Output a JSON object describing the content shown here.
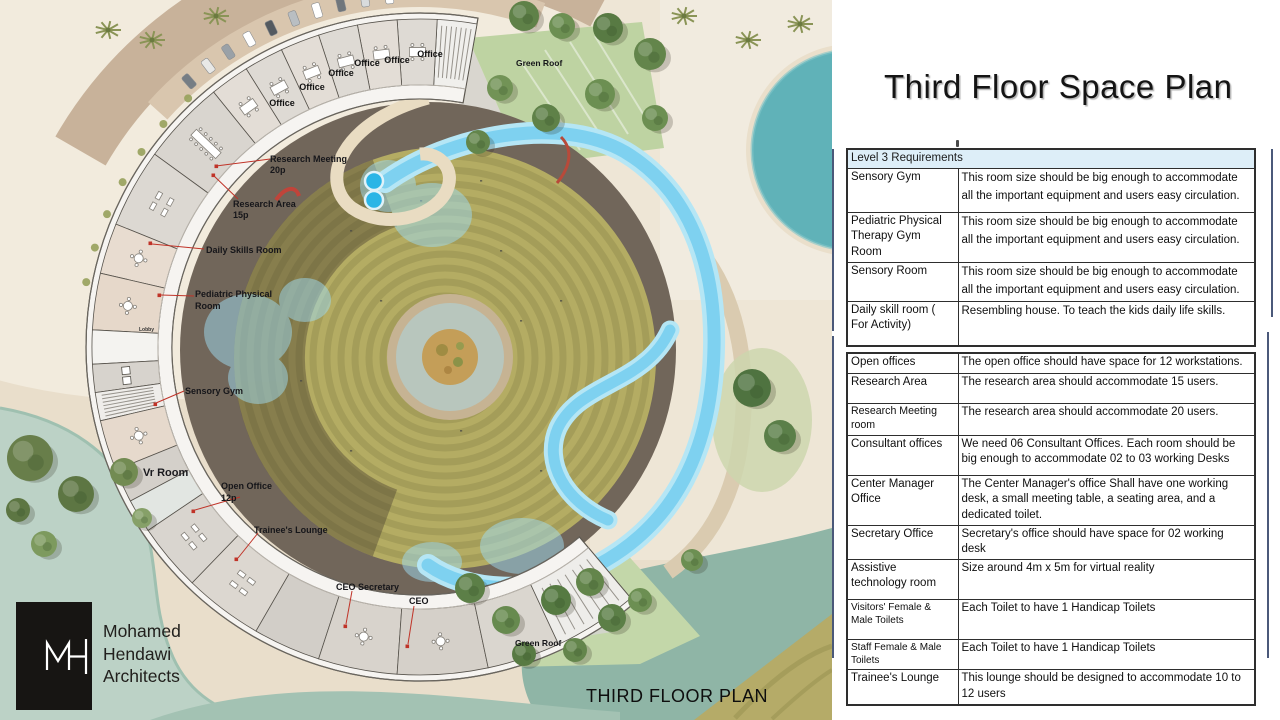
{
  "slide": {
    "title": "Third Floor Space Plan",
    "plan_caption": "THIRD FLOOR PLAN"
  },
  "logo": {
    "monogram": "MH",
    "firm_lines": [
      "Mohamed",
      "Hendawi",
      "Architects"
    ]
  },
  "plan": {
    "labels": {
      "office": "Office",
      "green_roof_top": "Green Roof",
      "green_roof_bottom": "Green Roof",
      "research_meeting": "Research Meeting",
      "research_meeting_cap": "20p",
      "research_area": "Research Area",
      "research_area_cap": "15p",
      "daily_skills": "Daily Skills Room",
      "pediatric_1": "Pediatric Physical",
      "pediatric_2": "Room",
      "lobby": "Lobby",
      "sensory_gym": "Sensory Gym",
      "vr_room": "Vr Room",
      "open_office": "Open Office",
      "open_office_cap": "12p",
      "trainees_lounge": "Trainee's Lounge",
      "ceo_secretary": "CEO Secretary",
      "ceo": "CEO"
    }
  },
  "requirements": {
    "header": "Level 3 Requirements",
    "tables": [
      {
        "rows": [
          {
            "room": "Sensory Gym",
            "req": "This room size should be big enough to accommodate\nall the important equipment and users easy circulation."
          },
          {
            "room": "Pediatric Physical Therapy Gym Room",
            "req": "This room size should be big enough to accommodate all the important equipment and users easy circulation."
          },
          {
            "room": "Sensory Room",
            "req": "This room size should be big enough to accommodate all the important equipment and users easy circulation."
          },
          {
            "room": "Daily skill room ( For Activity)",
            "req": "Resembling house. To teach the kids daily life skills."
          }
        ]
      },
      {
        "rows": [
          {
            "room": "Open offices",
            "req": "The open office should have space for 12 workstations."
          },
          {
            "room": "Research Area",
            "req": "The research area should accommodate 15 users."
          },
          {
            "room": "Research Meeting room",
            "req": "The research area should accommodate 20 users."
          },
          {
            "room": "Consultant offices",
            "req": "We need 06 Consultant Offices. Each room should be big enough to accommodate 02 to 03 working Desks"
          },
          {
            "room": "Center Manager Office",
            "req": "The Center Manager's office Shall have one working desk, a small meeting table, a seating area, and a dedicated toilet."
          },
          {
            "room": "Secretary Office",
            "req": "Secretary's office should have space for 02 working desk"
          },
          {
            "room": "Assistive technology room",
            "req": "Size around 4m x 5m for virtual reality"
          },
          {
            "room": "Visitors' Female & Male Toilets",
            "req": "Each Toilet to have 1 Handicap Toilets"
          },
          {
            "room": "Staff Female & Male Toilets",
            "req": "Each Toilet to have 1 Handicap Toilets"
          },
          {
            "room": "Trainee's Lounge",
            "req": "This lounge should be designed to accommodate 10 to 12 users"
          }
        ]
      }
    ]
  },
  "colors": {
    "leader_red": "#c03328",
    "table_header_bg": "#ddeef8",
    "pool_teal": "#60b2b8",
    "stream_blue": "#7ed1f0",
    "lawn_olive": "#b4ac63"
  }
}
